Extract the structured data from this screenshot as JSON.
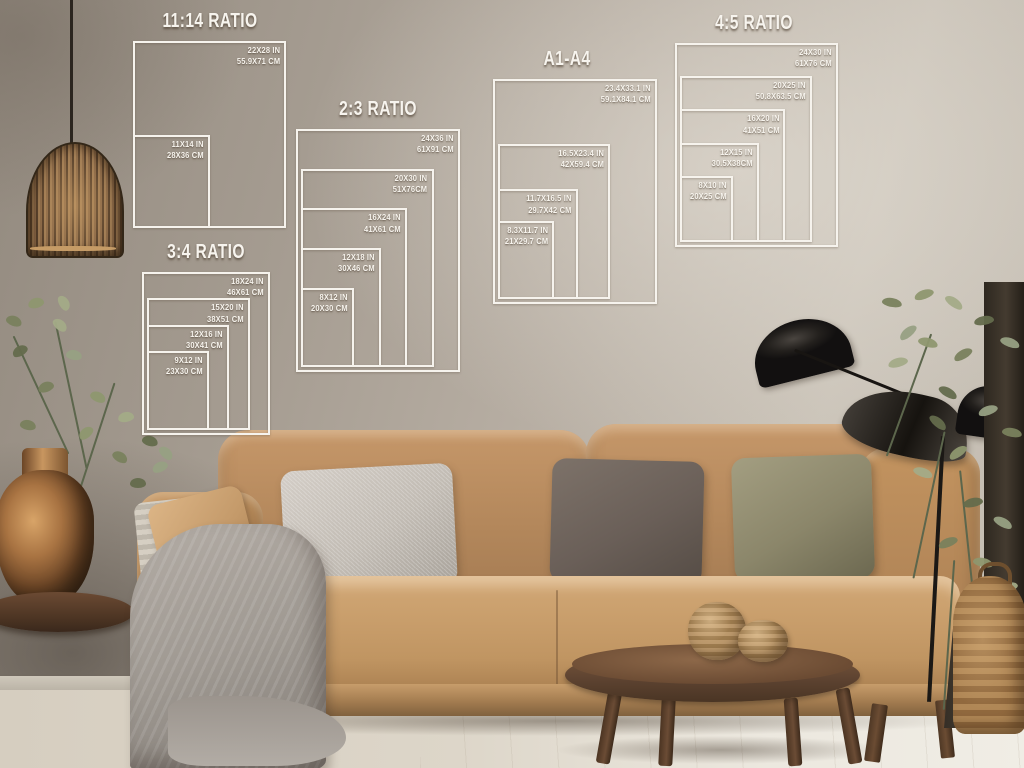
{
  "scene": {
    "type": "living-room product mockup photo",
    "overlay": "poster print size guide"
  },
  "colors": {
    "overlay_line": "#f6f3ed",
    "wall": "#b3aa9f",
    "couch_tan": "#bb9164",
    "floor": "#ddd6c9",
    "lamp_black": "#1d1a17",
    "brass": "#a06a38",
    "plant_green": "#848c68",
    "wood_dark": "#53392a"
  },
  "size_guides": [
    {
      "title": "11:14 RATIO",
      "sizes": [
        {
          "label_in": "22X28 IN",
          "label_cm": "55.9X71 CM",
          "w_in": 22,
          "h_in": 28
        },
        {
          "label_in": "11X14 IN",
          "label_cm": "28X36 CM",
          "w_in": 11,
          "h_in": 14
        }
      ]
    },
    {
      "title": "2:3 RATIO",
      "sizes": [
        {
          "label_in": "24X36 IN",
          "label_cm": "61X91 CM",
          "w_in": 24,
          "h_in": 36
        },
        {
          "label_in": "20X30 IN",
          "label_cm": "51X76CM",
          "w_in": 20,
          "h_in": 30
        },
        {
          "label_in": "16X24 IN",
          "label_cm": "41X61 CM",
          "w_in": 16,
          "h_in": 24
        },
        {
          "label_in": "12X18 IN",
          "label_cm": "30X46 CM",
          "w_in": 12,
          "h_in": 18
        },
        {
          "label_in": "8X12 IN",
          "label_cm": "20X30 CM",
          "w_in": 8,
          "h_in": 12
        }
      ]
    },
    {
      "title": "A1-A4",
      "sizes": [
        {
          "label_in": "23.4X33.1 IN",
          "label_cm": "59.1X84.1 CM",
          "w_in": 23.4,
          "h_in": 33.1
        },
        {
          "label_in": "16.5X23.4 IN",
          "label_cm": "42X59.4 CM",
          "w_in": 16.5,
          "h_in": 23.4
        },
        {
          "label_in": "11.7X16.5 IN",
          "label_cm": "29.7X42 CM",
          "w_in": 11.7,
          "h_in": 16.5
        },
        {
          "label_in": "8.3X11.7 IN",
          "label_cm": "21X29.7 CM",
          "w_in": 8.3,
          "h_in": 11.7
        }
      ]
    },
    {
      "title": "4:5 RATIO",
      "sizes": [
        {
          "label_in": "24X30 IN",
          "label_cm": "61X76 CM",
          "w_in": 24,
          "h_in": 30
        },
        {
          "label_in": "20X25 IN",
          "label_cm": "50.8X63.5 CM",
          "w_in": 20,
          "h_in": 25
        },
        {
          "label_in": "16X20 IN",
          "label_cm": "41X51 CM",
          "w_in": 16,
          "h_in": 20
        },
        {
          "label_in": "12X15 IN",
          "label_cm": "30.5X38CM",
          "w_in": 12,
          "h_in": 15
        },
        {
          "label_in": "8X10 IN",
          "label_cm": "20X25 CM",
          "w_in": 8,
          "h_in": 10
        }
      ]
    },
    {
      "title": "3:4 RATIO",
      "sizes": [
        {
          "label_in": "18X24 IN",
          "label_cm": "46X61 CM",
          "w_in": 18,
          "h_in": 24
        },
        {
          "label_in": "15X20 IN",
          "label_cm": "38X51 CM",
          "w_in": 15,
          "h_in": 20
        },
        {
          "label_in": "12X16 IN",
          "label_cm": "30X41 CM",
          "w_in": 12,
          "h_in": 16
        },
        {
          "label_in": "9X12 IN",
          "label_cm": "23X30 CM",
          "w_in": 9,
          "h_in": 12
        }
      ]
    }
  ]
}
